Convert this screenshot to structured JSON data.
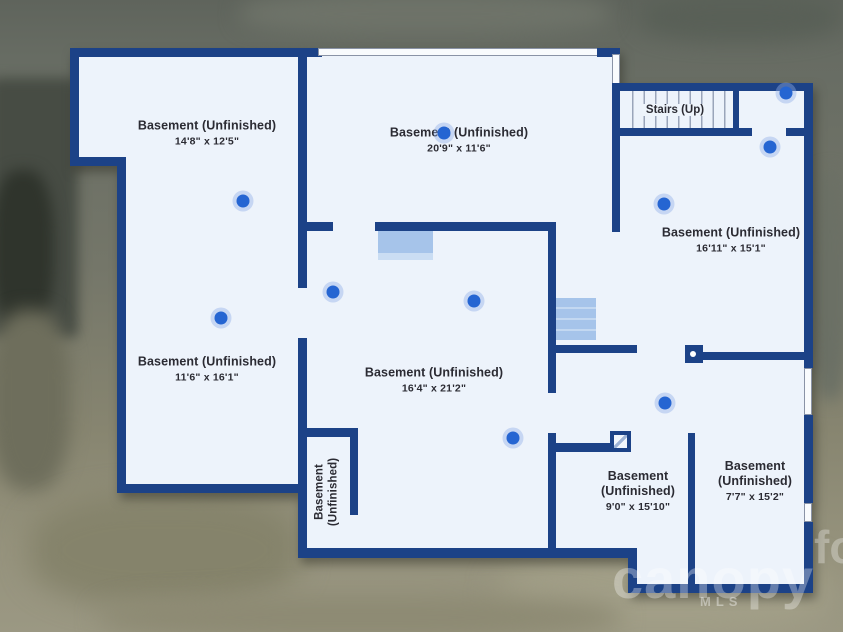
{
  "plan": {
    "stairs_label": "Stairs (Up)",
    "rooms": [
      {
        "name": "Basement (Unfinished)",
        "dims": "14'8\" x 12'5\""
      },
      {
        "name": "Basement (Unfinished)",
        "dims": "20'9\" x 11'6\""
      },
      {
        "name": "Basement (Unfinished)",
        "dims": "16'11\" x 15'1\""
      },
      {
        "name": "Basement (Unfinished)",
        "dims": "11'6\" x 16'1\""
      },
      {
        "name": "Basement (Unfinished)",
        "dims": "16'4\" x 21'2\""
      },
      {
        "name": "Basement (Unfinished)",
        "dims": ""
      },
      {
        "name": "Basement (Unfinished)",
        "dims": "9'0\" x 15'10\""
      },
      {
        "name": "Basement (Unfinished)",
        "dims": "7'7\" x 15'2\""
      }
    ]
  },
  "watermark": {
    "brand": "canopy",
    "sub": "MLS",
    "fragment": "fo"
  },
  "markers": [
    {
      "x": 243,
      "y": 201
    },
    {
      "x": 444,
      "y": 133
    },
    {
      "x": 786,
      "y": 93
    },
    {
      "x": 770,
      "y": 147
    },
    {
      "x": 664,
      "y": 204
    },
    {
      "x": 221,
      "y": 318
    },
    {
      "x": 333,
      "y": 292
    },
    {
      "x": 474,
      "y": 301
    },
    {
      "x": 665,
      "y": 403
    },
    {
      "x": 513,
      "y": 438
    }
  ],
  "colors": {
    "wall": "#1c4287",
    "floor": "#edf3fb",
    "marker": "#2565d2",
    "fixture": "#a6c4ea"
  }
}
